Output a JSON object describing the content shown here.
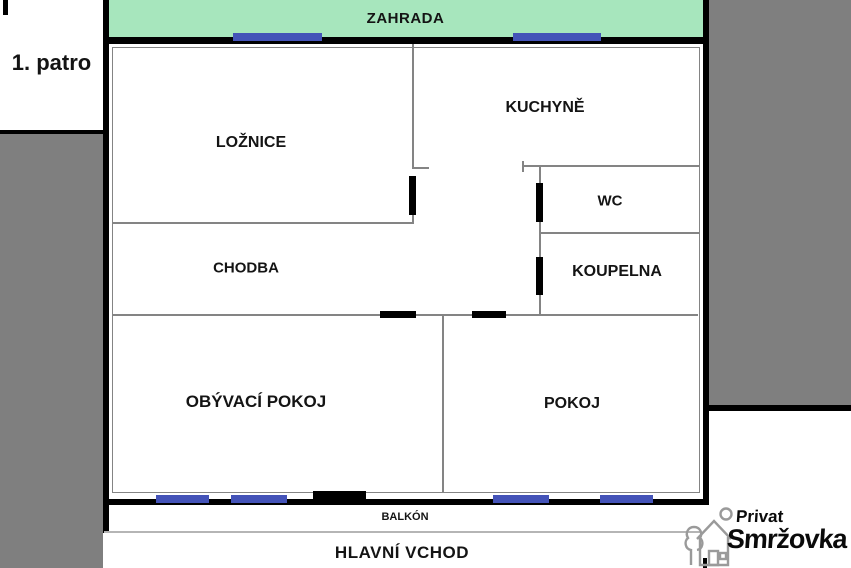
{
  "floor_label": "1. patro",
  "areas": {
    "garden": {
      "label": "ZAHRADA"
    },
    "balcony": {
      "label": "BALKÓN"
    },
    "entrance": {
      "label": "HLAVNÍ VCHOD"
    }
  },
  "rooms": [
    {
      "id": "loznice",
      "label": "LOŽNICE"
    },
    {
      "id": "kuchyne",
      "label": "KUCHYNĚ"
    },
    {
      "id": "wc",
      "label": "WC"
    },
    {
      "id": "koupelna",
      "label": "KOUPELNA"
    },
    {
      "id": "chodba",
      "label": "CHODBA"
    },
    {
      "id": "obyvaci-pokoj",
      "label": "OBÝVACÍ POKOJ"
    },
    {
      "id": "pokoj",
      "label": "POKOJ"
    }
  ],
  "logo": {
    "line1": "Privat",
    "line2": "Smržovka"
  },
  "colors": {
    "garden_green": "#a7e6bd",
    "window_blue": "#4453b8",
    "outside_gray": "#7f7f7f",
    "wall_black": "#000000",
    "thin_wall_gray": "#848484",
    "balcony_line_gray": "#b5b5b5",
    "logo_gray": "#9a9a9a"
  }
}
